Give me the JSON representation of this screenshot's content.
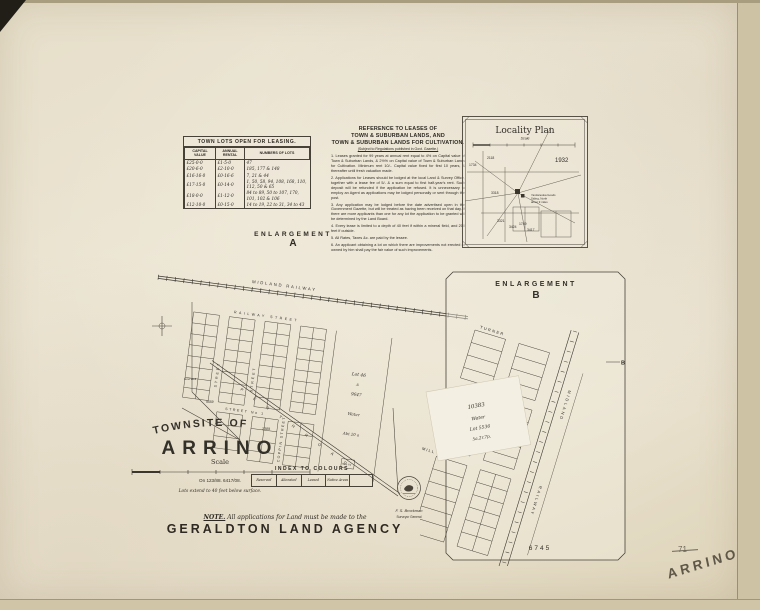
{
  "page": {
    "handwritten_name": "ARRINO",
    "page_number": "71"
  },
  "lease_table": {
    "title": "TOWN LOTS OPEN FOR LEASING.",
    "columns": [
      "CAPITAL VALUE",
      "ANNUAL RENTAL",
      "NUMBERS OF LOTS"
    ],
    "rows": [
      [
        "£25-0-0",
        "£1-5-0",
        "47"
      ],
      [
        "£20-6-0",
        "£2-10-0",
        "185, 177 & 148"
      ],
      [
        "£16-16-0",
        "£0-16-6",
        "7, 21 & 44"
      ],
      [
        "£17-15-0",
        "£0-14-0",
        "1, 50, 58, 94, 108, 168, 110, 112, 50 & 65"
      ],
      [
        "£18-0-0",
        "£1-12-0",
        "84 to 89, 50 to 107, 170, 101, 102 & 106"
      ],
      [
        "£12-10-0",
        "£0-15-0",
        "14 to 19, 22 to 31, 34 to 43"
      ]
    ]
  },
  "reference": {
    "title_line1": "REFERENCE TO LEASES OF",
    "title_line2": "TOWN & SUBURBAN LANDS, AND",
    "title_line3": "TOWN & SUBURBAN LANDS FOR CULTIVATION.",
    "subtitle": "(Subject to Regulations published in Govt. Gazette.)",
    "items": [
      "1.  Leases granted for 99 years at annual rent equal to 4% on Capital value of Town & Suburban Lands, & 2½% on Capital value of Town & Suburban Lands for Cultivation. Minimum rent 10/-. Capital value fixed for first 10 years, & thereafter until fresh valuation made.",
      "2.  Applications for Leases should be lodged at the local Land & Survey Office, together with a lease fee of 5/- & a sum equal to first half-year's rent. Such deposit will be refunded if the application be refused. It is unnecessary to employ an Agent as applications may be lodged personally or sent through the post.",
      "3.  Any application may be lodged before the date advertised open in the Government Gazette, but will be treated as having been received on that day. If there are more applicants than one for any lot the application to be granted will be determined by the Land Board.",
      "4.  Every lease is limited to a depth of 40 feet if within a mineral field, and 200 feet if outside.",
      "5.  All Rates, Taxes &c. are paid by the lessee.",
      "6.  An applicant obtaining a lot on which there are improvements not erected or owned by him shall pay the fair value of such improvements."
    ]
  },
  "locality_plan": {
    "title": "Locality Plan",
    "scale_label": "Scale",
    "year": "1932",
    "labels": [
      "2118",
      "1734",
      "3318",
      "3321",
      "3424",
      "1749",
      "3417"
    ],
    "note_lines": [
      "Yandanooka Goods",
      "Siding, North",
      "about 9 miles"
    ]
  },
  "enlargement_a": {
    "label": "ENLARGEMENT",
    "letter": "A",
    "railway": "MIDLAND  RAILWAY",
    "streets": {
      "railway_street": "RAILWAY    STREET",
      "v1": "STREET",
      "v2": "STREET",
      "v3": "COPPIN  STREET",
      "street_no1": "STREET  No 1",
      "perth_road": "P E R T H      R O A D"
    },
    "lot46": [
      "Lot 46",
      "A",
      "9647",
      "Water",
      "Abt 20 a"
    ],
    "numbers": [
      "9559",
      "2389"
    ],
    "labels": {
      "govt_well": "Govt Well",
      "sale_yard": "Sale Yd"
    }
  },
  "title_block": {
    "pre": "TOWNSITE  OF",
    "name": "ARRINO",
    "scale_label": "Scale",
    "file_ref": "On 123/88.  6417/08.",
    "depth_note": "Lots  extend  to  40  feet  below  surface."
  },
  "index_to_colours": {
    "title": "INDEX  TO  COLOURS",
    "cells": [
      "Reserved",
      "Alienated",
      "Leased",
      "Native Areas",
      ""
    ]
  },
  "note": {
    "prefix": "NOTE.",
    "text": " All applications for Land must be made to the",
    "agency": "GERALDTON LAND AGENCY"
  },
  "stamp": {
    "line1": "F. S. Brockman",
    "line2": "Surveyor General"
  },
  "enlargement_b": {
    "label": "ENLARGEMENT",
    "letter": "B",
    "streets": [
      "TURNER",
      "DALY",
      "MILL"
    ],
    "railway": [
      "MIDLAND",
      "RAILWAY"
    ],
    "overlay": [
      "10383",
      "Water",
      "Lot 5536",
      "5a.2r.7p."
    ],
    "bottom_number": "6745",
    "marker": "B"
  }
}
